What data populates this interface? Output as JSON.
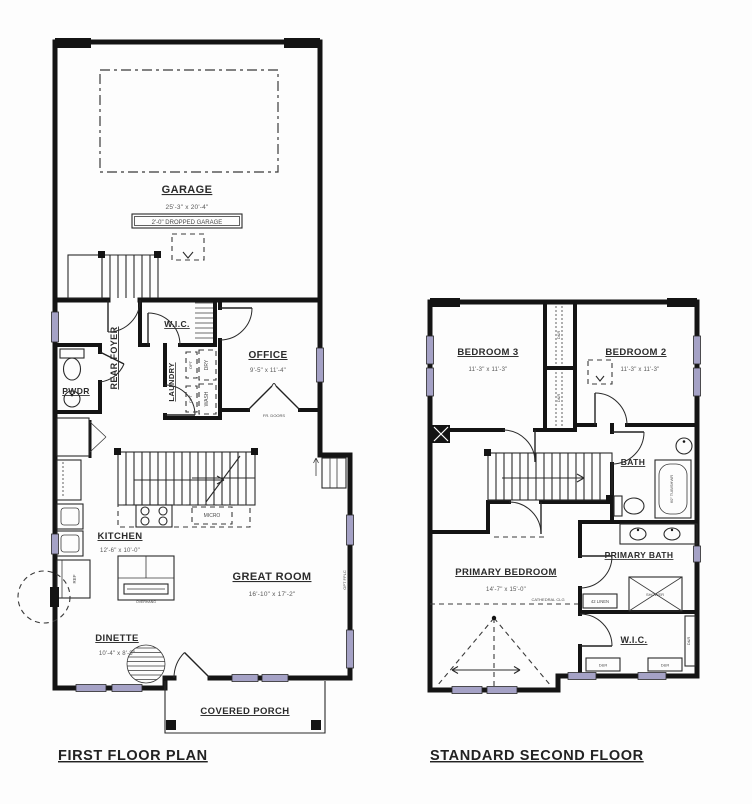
{
  "colors": {
    "wall": "#141414",
    "window": "#a5a2c6",
    "label": "#2b2b2b",
    "dim": "#585858"
  },
  "first_floor": {
    "title": "FIRST FLOOR PLAN",
    "garage": {
      "name": "GARAGE",
      "dims": "25'-3\" x 20'-4\"",
      "note": "2'-0\" DROPPED GARAGE"
    },
    "wic": "W.I.C.",
    "rear_foyer": "REAR FOYER",
    "pwdr": "PWDR",
    "laundry": {
      "name": "LAUNDRY",
      "dry": "DRY",
      "wash": "WASH",
      "opt": "OPT"
    },
    "office": {
      "name": "OFFICE",
      "dims": "9'-5\" x 11'-4\"",
      "doors": "FR. DOORS"
    },
    "kitchen": {
      "name": "KITCHEN",
      "dims": "12'-6\" x 10'-0\"",
      "micro": "MICRO",
      "ref": "REF",
      "island": "OVERHANG"
    },
    "great_room": {
      "name": "GREAT ROOM",
      "dims": "16'-10\" x 17'-2\"",
      "opt_fplc": "OPT FPLC"
    },
    "dinette": {
      "name": "DINETTE",
      "dims": "10'-4\" x 8'-8\""
    },
    "covered_porch": "COVERED PORCH"
  },
  "second_floor": {
    "title": "STANDARD SECOND FLOOR",
    "bedroom3": {
      "name": "BEDROOM 3",
      "dims": "11'-3\" x 11'-3\""
    },
    "bedroom2": {
      "name": "BEDROOM 2",
      "dims": "11'-3\" x 11'-3\""
    },
    "bath": {
      "name": "BATH",
      "tub": "60\" TUB/SHWR"
    },
    "primary_bath": {
      "name": "PRIMARY BATH",
      "linen": "42 LINEN",
      "shower": "SHOWER"
    },
    "primary_bedroom": {
      "name": "PRIMARY BEDROOM",
      "dims": "14'-7\" x 15'-0\"",
      "ceiling": "CATHEDRAL CLG"
    },
    "wic": {
      "name": "W.I.C.",
      "dr": "D&R"
    }
  }
}
